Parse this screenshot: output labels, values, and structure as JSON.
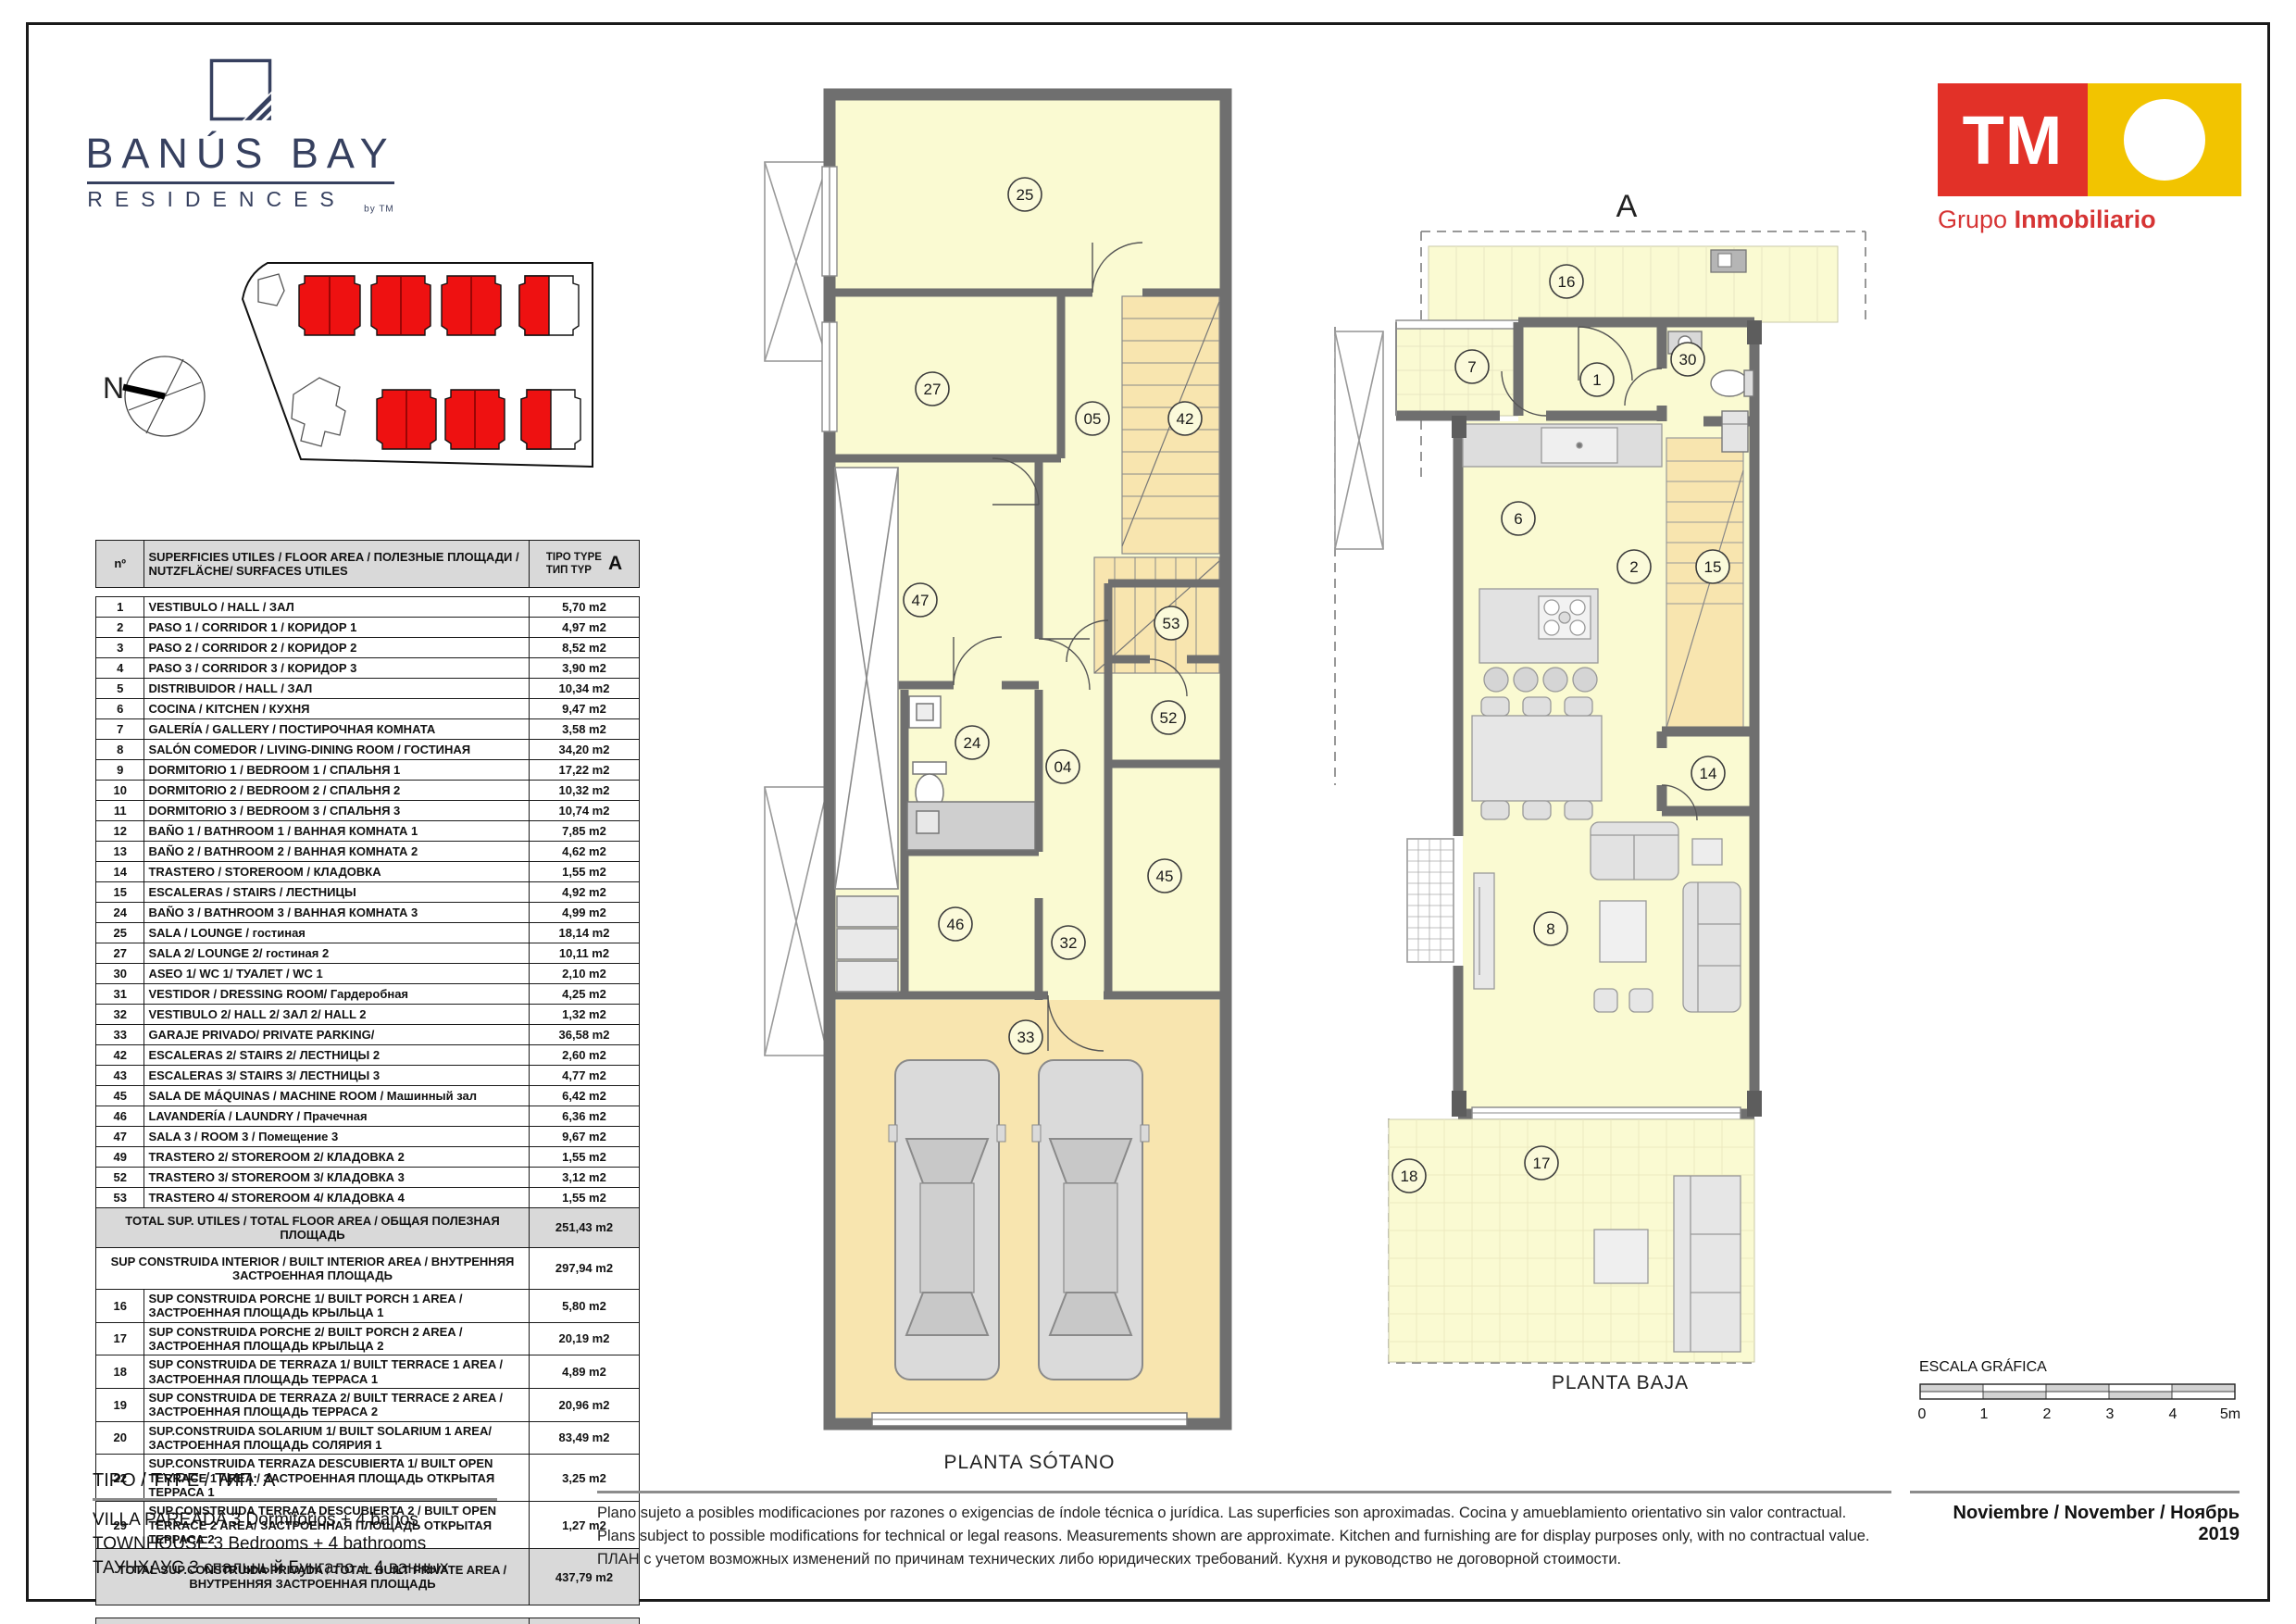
{
  "brand": {
    "line1": "BANÚS BAY",
    "line2": "RESIDENCES",
    "byline": "by TM"
  },
  "developer": {
    "logo_text": "TM",
    "sub_light": "Grupo",
    "sub_bold": "Inmobiliario",
    "red": "#e23128",
    "yellow": "#f2c400"
  },
  "compass": {
    "label": "N"
  },
  "table": {
    "header": {
      "col_num": "nº",
      "col_desc": "SUPERFICIES UTILES / FLOOR AREA / ПОЛЕЗНЫЕ ПЛОЩАДИ / NUTZFLÄCHE/ SURFACES UTILES",
      "type_line1": "TIPO TYPE",
      "type_line2": "ТИП TYP",
      "type_letter": "A"
    },
    "rows": [
      {
        "n": "1",
        "d": "VESTIBULO / HALL / ЗАЛ",
        "v": "5,70 m2"
      },
      {
        "n": "2",
        "d": "PASO 1 / CORRIDOR 1 / КОРИДОР 1",
        "v": "4,97 m2"
      },
      {
        "n": "3",
        "d": "PASO 2 / CORRIDOR 2 / КОРИДОР 2",
        "v": "8,52 m2"
      },
      {
        "n": "4",
        "d": "PASO 3 / CORRIDOR 3 / КОРИДОР 3",
        "v": "3,90 m2"
      },
      {
        "n": "5",
        "d": "DISTRIBUIDOR /  HALL / ЗАЛ",
        "v": "10,34 m2"
      },
      {
        "n": "6",
        "d": "COCINA / KITCHEN / КУХНЯ",
        "v": "9,47 m2"
      },
      {
        "n": "7",
        "d": "GALERÍA / GALLERY / ПОСТИРОЧНАЯ КОМНАТА",
        "v": "3,58 m2"
      },
      {
        "n": "8",
        "d": "SALÓN COMEDOR  / LIVING-DINING ROOM / ГОСТИНАЯ",
        "v": "34,20 m2"
      },
      {
        "n": "9",
        "d": "DORMITORIO 1 / BEDROOM 1 / СПАЛЬНЯ 1",
        "v": "17,22 m2"
      },
      {
        "n": "10",
        "d": "DORMITORIO 2 / BEDROOM 2 / СПАЛЬНЯ 2",
        "v": "10,32 m2"
      },
      {
        "n": "11",
        "d": "DORMITORIO 3 / BEDROOM 3 / СПАЛЬНЯ 3",
        "v": "10,74 m2"
      },
      {
        "n": "12",
        "d": "BAÑO 1 / BATHROOM 1 / ВАННАЯ КОМНАТА 1",
        "v": "7,85 m2"
      },
      {
        "n": "13",
        "d": "BAÑO 2 / BATHROOM 2 / ВАННАЯ КОМНАТА 2",
        "v": "4,62 m2"
      },
      {
        "n": "14",
        "d": "TRASTERO / STOREROOM / КЛАДОВКА",
        "v": "1,55 m2"
      },
      {
        "n": "15",
        "d": "ESCALERAS / STAIRS / ЛЕСТНИЦЫ",
        "v": "4,92 m2"
      },
      {
        "n": "24",
        "d": "BAÑO 3 / BATHROOM 3 / ВАННАЯ КОМНАТА 3",
        "v": "4,99 m2"
      },
      {
        "n": "25",
        "d": "SALA / LOUNGE / гостиная",
        "v": "18,14 m2"
      },
      {
        "n": "27",
        "d": "SALA 2/ LOUNGE 2/ гостиная 2",
        "v": "10,11 m2"
      },
      {
        "n": "30",
        "d": "ASEO 1/ WC 1/ ТУАЛЕТ / WC 1",
        "v": "2,10 m2"
      },
      {
        "n": "31",
        "d": "VESTIDOR / DRESSING ROOM/ Гардеробная",
        "v": "4,25 m2"
      },
      {
        "n": "32",
        "d": "VESTIBULO 2/ HALL 2/ ЗАЛ 2/ HALL 2",
        "v": "1,32 m2"
      },
      {
        "n": "33",
        "d": "GARAJE PRIVADO/ PRIVATE PARKING/",
        "v": "36,58 m2"
      },
      {
        "n": "42",
        "d": "ESCALERAS 2/ STAIRS 2/ ЛЕСТНИЦЫ 2",
        "v": "2,60 m2"
      },
      {
        "n": "43",
        "d": "ESCALERAS 3/ STAIRS 3/ ЛЕСТНИЦЫ 3",
        "v": "4,77 m2"
      },
      {
        "n": "45",
        "d": "SALA DE MÁQUINAS / MACHINE ROOM / Машинный зал",
        "v": "6,42 m2"
      },
      {
        "n": "46",
        "d": "LAVANDERÍA / LAUNDRY / Прачечная",
        "v": "6,36 m2"
      },
      {
        "n": "47",
        "d": "SALA 3 / ROOM 3 / Помещение 3",
        "v": "9,67 m2"
      },
      {
        "n": "49",
        "d": "TRASTERO  2/ STOREROOM 2/ КЛАДОВКА 2",
        "v": "1,55 m2"
      },
      {
        "n": "52",
        "d": "TRASTERO 3/ STOREROOM 3/ КЛАДОВКА  3",
        "v": "3,12 m2"
      },
      {
        "n": "53",
        "d": "TRASTERO 4/ STOREROOM 4/ КЛАДОВКА  4",
        "v": "1,55 m2"
      }
    ],
    "total_utiles": {
      "d": "TOTAL SUP. UTILES / TOTAL FLOOR AREA / ОБЩАЯ ПОЛЕЗНАЯ ПЛОЩАДЬ",
      "v": "251,43 m2"
    },
    "construida_interior": {
      "d": "SUP CONSTRUIDA INTERIOR / BUILT INTERIOR AREA / ВНУТРЕННЯЯ ЗАСТРОЕННАЯ ПЛОЩАДЬ",
      "v": "297,94 m2"
    },
    "built_rows": [
      {
        "n": "16",
        "d": "SUP CONSTRUIDA PORCHE 1/ BUILT PORCH 1 AREA / ЗАСТРОЕННАЯ ПЛОЩАДЬ КРЫЛЬЦА 1",
        "v": "5,80 m2"
      },
      {
        "n": "17",
        "d": "SUP CONSTRUIDA PORCHE 2/ BUILT PORCH 2 AREA / ЗАСТРОЕННАЯ ПЛОЩАДЬ КРЫЛЬЦА 2",
        "v": "20,19 m2"
      },
      {
        "n": "18",
        "d": "SUP CONSTRUIDA  DE TERRAZA 1/ BUILT TERRACE 1 AREA / ЗАСТРОЕННАЯ ПЛОЩАДЬ ТЕРРАСА 1",
        "v": "4,89 m2"
      },
      {
        "n": "19",
        "d": "SUP CONSTRUIDA  DE TERRAZA 2/ BUILT TERRACE 2 AREA / ЗАСТРОЕННАЯ ПЛОЩАДЬ  ТЕРРАСА 2",
        "v": "20,96 m2"
      },
      {
        "n": "20",
        "d": "SUP.CONSTRUIDA SOLARIUM 1/ BUILT SOLARIUM 1 AREA/  ЗАСТРОЕННАЯ ПЛОЩАДЬ СОЛЯРИЯ  1",
        "v": "83,49 m2"
      },
      {
        "n": "22",
        "d": "SUP.CONSTRUIDA TERRAZA DESCUBIERTA 1/ BUILT OPEN TERRACE 1 AREA / ЗАСТРОЕННАЯ ПЛОЩАДЬ ОТКРЫТАЯ ТЕРРАСА  1",
        "v": "3,25 m2"
      },
      {
        "n": "29",
        "d": "SUP.CONSTRUIDA TERRAZA DESCUBIERTA 2 / BUILT OPEN TERRACE 2 AREA/ ЗАСТРОЕННАЯ ПЛОЩАДЬ ОТКРЫТАЯ ТЕРРАСА  2",
        "v": "1,27 m2"
      }
    ],
    "total_privada": {
      "d": "TOTAL SUP.CONSTRUIDA PRIVADA / TOTAL  BUILT PRIVATE AREA / ВНУТРЕННЯЯ ЗАСТРОЕННАЯ ПЛОЩАДЬ",
      "v": "437,79 m2"
    },
    "jardin": {
      "d": "SUP. JARDIN desde-hasta / GARDEN AREA from -to / Площадь палисадника от-до",
      "v1": "65 m2",
      "v2": "159 m2"
    }
  },
  "plans": {
    "sotano": {
      "caption": "PLANTA SÓTANO",
      "rooms": [
        "25",
        "27",
        "05",
        "42",
        "47",
        "53",
        "24",
        "52",
        "04",
        "45",
        "46",
        "32",
        "33"
      ]
    },
    "baja": {
      "caption": "PLANTA BAJA",
      "marker": "A",
      "rooms": [
        "16",
        "7",
        "1",
        "30",
        "6",
        "2",
        "15",
        "14",
        "8",
        "17",
        "18"
      ]
    },
    "colors": {
      "room_fill": "#FAFAD2",
      "stairs_fill": "#F8E5AF",
      "wall": "#6F6F6F",
      "site_building_red": "#EE1111"
    }
  },
  "scalebar": {
    "title": "ESCALA GRÁFICA",
    "ticks": [
      "0",
      "1",
      "2",
      "3",
      "4",
      "5m"
    ]
  },
  "footer": {
    "tipo": "TIPO / TYPE / ТИП: A",
    "lines": [
      "VILLA PAREADA 3 Dormitorios + 4 baños",
      "TOWNHOUSE 3 Bedrooms + 4 bathrooms",
      "ТАУНХАУС 3 спальный Бунгало + 4 ванных"
    ],
    "disclaimer": [
      "Plano sujeto a posibles modificaciones por razones o exigencias de índole técnica o jurídica. Las superficies son aproximadas. Cocina y amueblamiento orientativo sin valor contractual.",
      "Plans subject to possible modifications for technical or legal reasons. Measurements shown are approximate. Kitchen and furnishing are for display purposes only, with no contractual value.",
      "ПЛАН с учетом возможных изменений по причинам технических либо юридических требований. Кухня и руководство не договорной стоимости."
    ],
    "date": "Noviembre / November / Ноябрь 2019"
  }
}
